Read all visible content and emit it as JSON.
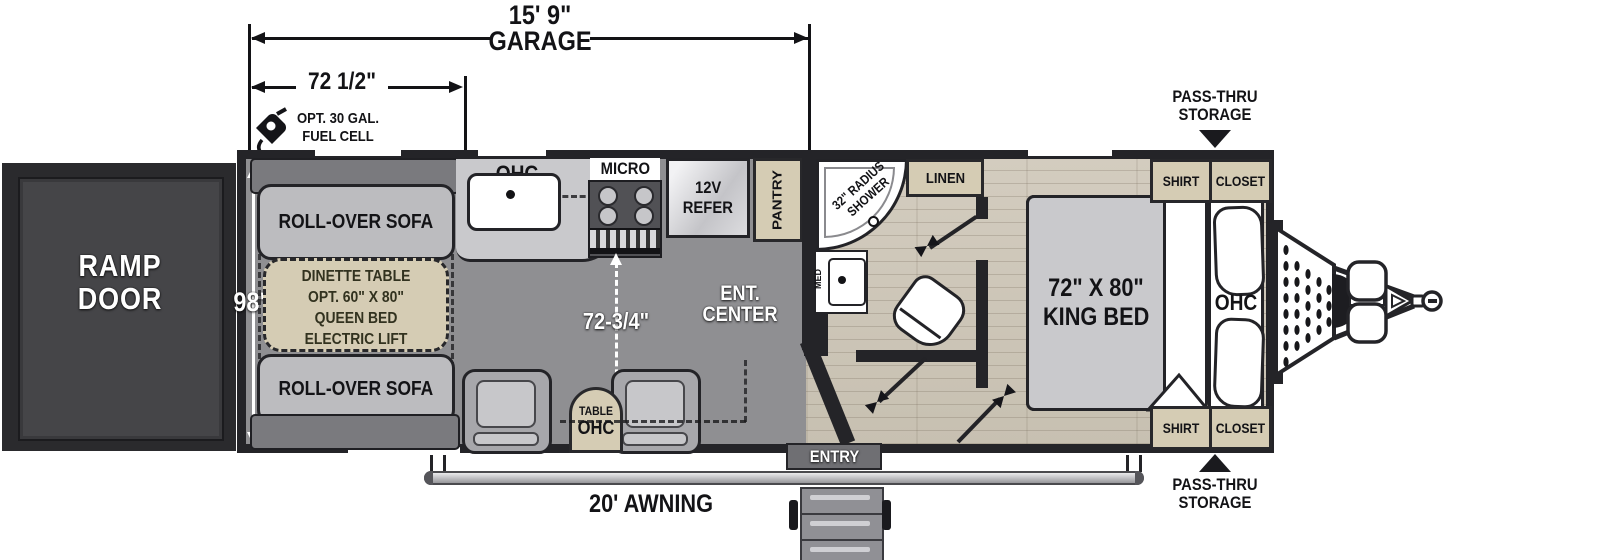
{
  "dimensions": {
    "garage_length": "15' 9\"",
    "garage_word": "GARAGE",
    "front_span": "72 1/2\"",
    "body_width": "98\"",
    "garage_width": "72-3/4\""
  },
  "exterior": {
    "fuel_line1": "OPT. 30 GAL.",
    "fuel_line2": "FUEL CELL",
    "ramp_line1": "RAMP",
    "ramp_line2": "DOOR",
    "entry": "ENTRY",
    "awning": "20' AWNING",
    "passthru_line1": "PASS-THRU",
    "passthru_line2": "STORAGE"
  },
  "garage": {
    "sofa_top": "ROLL-OVER SOFA",
    "sofa_bottom": "ROLL-OVER SOFA",
    "dinette_line1": "DINETTE TABLE",
    "dinette_line2": "OPT. 60\" X 80\"",
    "dinette_line3": "QUEEN BED",
    "dinette_line4": "ELECTRIC LIFT"
  },
  "kitchen": {
    "ohc": "OHC",
    "micro": "MICRO",
    "refer_line1": "12V",
    "refer_line2": "REFER",
    "pantry": "PANTRY",
    "ent_line1": "ENT.",
    "ent_line2": "CENTER",
    "table_line1": "TABLE",
    "table_line2": "OHC"
  },
  "bathroom": {
    "shower_line1": "32\" RADIUS",
    "shower_line2": "SHOWER",
    "linen": "LINEN",
    "med": "MED"
  },
  "bedroom": {
    "bed_line1": "72\" X 80\"",
    "bed_line2": "KING BED",
    "ohc": "OHC",
    "shirt": "SHIRT",
    "closet": "CLOSET"
  },
  "colors": {
    "wall": "#242428",
    "garage_floor": "#8f8f92",
    "wood_floor": "#cfc8bb",
    "cabinet_tan": "#d5ccb4",
    "ramp_door": "#454548"
  }
}
